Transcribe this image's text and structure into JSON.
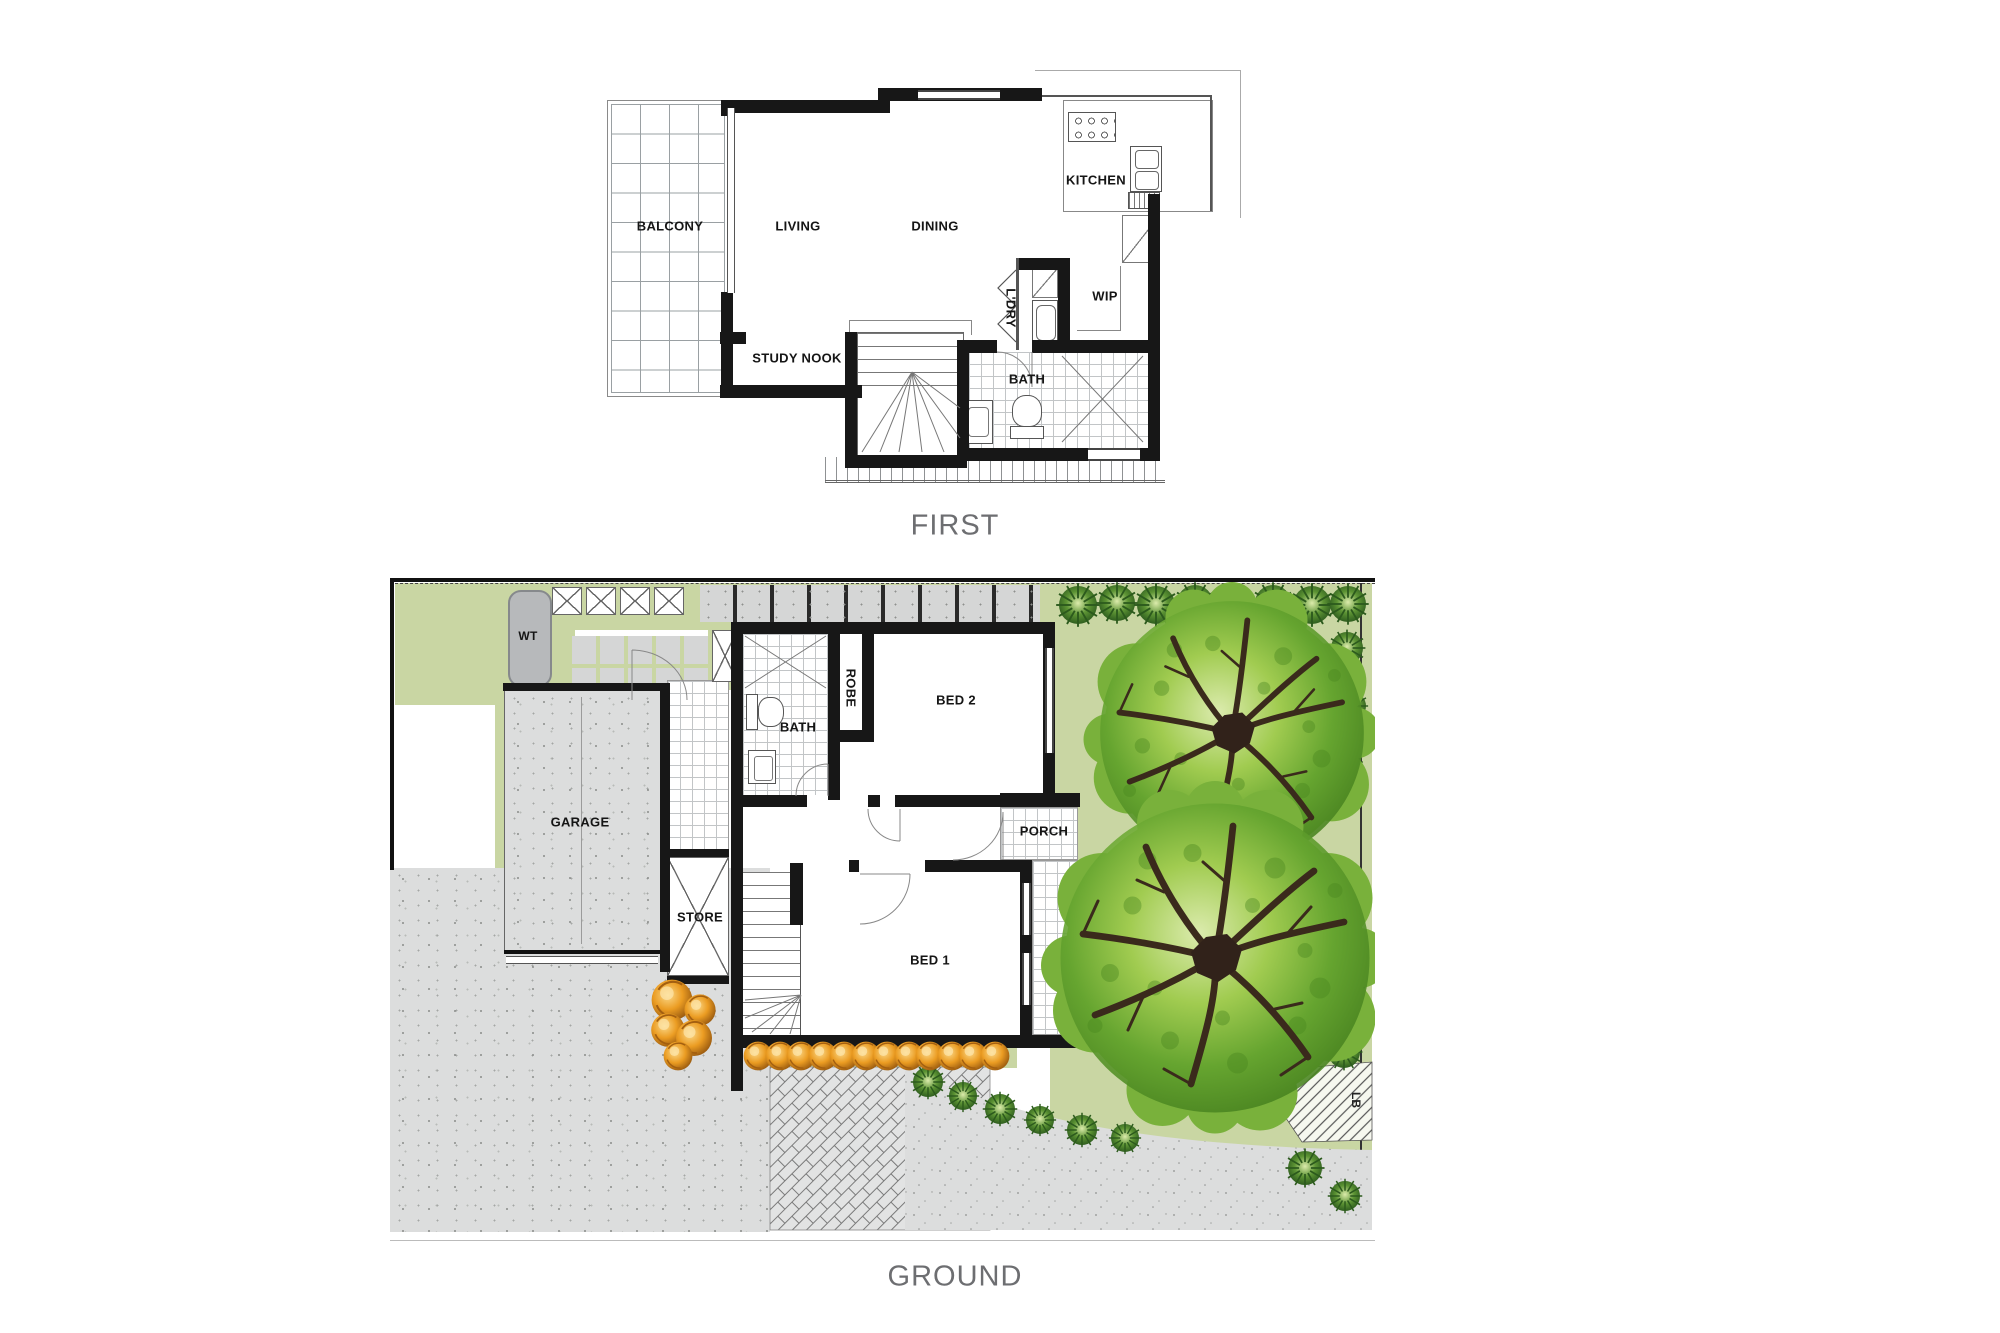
{
  "document": {
    "type": "Residential floor plan, two levels"
  },
  "first_floor": {
    "title": "FIRST",
    "rooms": {
      "balcony": "BALCONY",
      "living": "LIVING",
      "dining": "DINING",
      "kitchen": "KITCHEN",
      "wip": "WIP",
      "laundry": "L'DRY",
      "study_nook": "STUDY NOOK",
      "bath": "BATH"
    }
  },
  "ground_floor": {
    "title": "GROUND",
    "rooms": {
      "water_tank": "WT",
      "garage": "GARAGE",
      "bath": "BATH",
      "robe": "ROBE",
      "bed2": "BED 2",
      "porch": "PORCH",
      "store": "STORE",
      "bed1": "BED 1",
      "letterbox": "LB"
    }
  },
  "colors": {
    "wall": "#171717",
    "lawn": "#c9d6a3",
    "tree_green": "#79b13b",
    "shrub_orange": "#e8941a",
    "concrete": "#dcdddd",
    "level_label_gray": "#6d6e71"
  }
}
